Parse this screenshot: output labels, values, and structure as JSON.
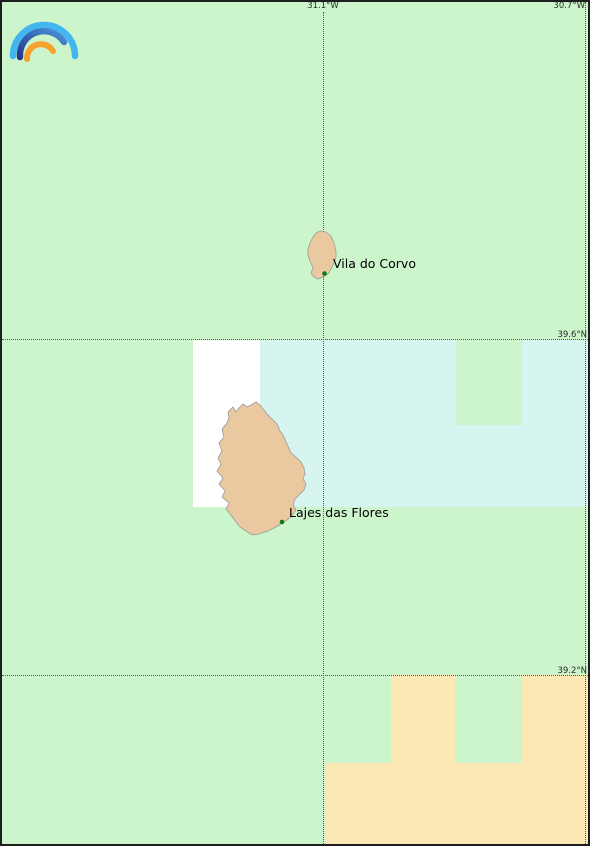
{
  "map": {
    "grid": {
      "meridians": [
        {
          "label": "31.1°W"
        },
        {
          "label": "30.7°W"
        }
      ],
      "parallels": [
        {
          "label": "39.6°N"
        },
        {
          "label": "39.2°N"
        }
      ]
    },
    "places": [
      {
        "name": "Vila do Corvo"
      },
      {
        "name": "Lajes das Flores"
      }
    ],
    "islands": [
      {
        "name": "Corvo"
      },
      {
        "name": "Flores"
      }
    ],
    "colors": {
      "land_green": "#cdf5cb",
      "sea_cyan": "#d6f4f0",
      "sand_orange": "#fce8b4",
      "region_white": "#ffffff",
      "island_fill": "#eac9a0",
      "island_stroke": "#9a9a9a",
      "marker_green": "#0b7d10",
      "gridline": "#555555",
      "frame": "#1e1e1e"
    },
    "logo": {
      "name": "rainbow-arcs-logo",
      "arc_colors": [
        "#44b6ef",
        "#24398c",
        "#4b93d9",
        "#f9a12d"
      ]
    }
  }
}
